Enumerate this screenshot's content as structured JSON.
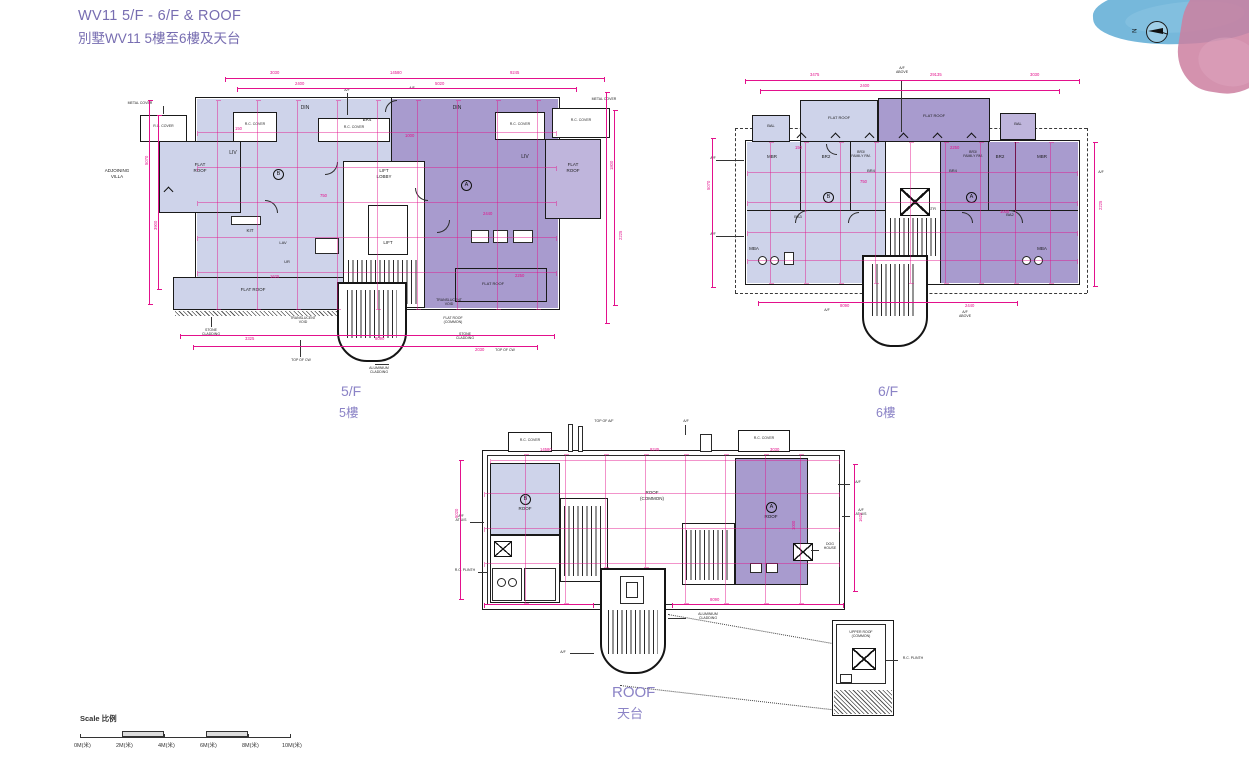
{
  "title": {
    "line1": "WV11  5/F - 6/F & ROOF",
    "line2": "別墅WV11  5樓至6樓及天台"
  },
  "compass": {
    "north": "N"
  },
  "captions": {
    "f5_en": "5/F",
    "f5_zh": "5樓",
    "f6_en": "6/F",
    "f6_zh": "6樓",
    "roof_en": "ROOF",
    "roof_zh": "天台"
  },
  "units": {
    "a": "A",
    "b": "B"
  },
  "rooms": {
    "flat_roof": "FLAT ROOF",
    "flat_1": "FLAT",
    "flat_2": "ROOF",
    "din": "DIN",
    "liv": "LIV",
    "kit": "KIT",
    "lav": "LAV",
    "ur": "UR",
    "lift": "LIFT",
    "lift_lobby_1": "LIFT",
    "lift_lobby_2": "LOBBY",
    "mbr": "MBR",
    "br2": "BR2",
    "br3": "BR3/",
    "family_rm": "FAMILY RM.",
    "br4": "BR4",
    "bal": "BAL",
    "mba": "MBA",
    "ba2": "BA2",
    "ba3": "BA3",
    "str": "STR",
    "roof": "ROOF",
    "roof_common_1": "ROOF",
    "roof_common_2": "(COMMON)",
    "upper_roof_1": "UPPER ROOF",
    "upper_roof_2": "(COMMON)",
    "flat_roof_common_1": "FLAT ROOF",
    "flat_roof_common_2": "(COMMON)"
  },
  "annos": {
    "adjoining_1": "ADJOINING",
    "adjoining_2": "VILLA",
    "metal_cover": "METAL COVER",
    "rc_cover": "R.C. COVER",
    "stone_1": "STONE",
    "stone_2": "CLADDING",
    "top_of_cw": "TOP OF CW",
    "translucent_1": "TRANSLUCENT",
    "translucent_2": "VOID",
    "af": "A/F",
    "af_above_1": "A/F",
    "af_above_2": "ABOVE",
    "top_of_af": "TOP OF A/F",
    "af_at_us_1": "A/F",
    "af_at_us_2": "AT U/S",
    "dog_1": "DOG",
    "dog_2": "HOUSE",
    "rc_plinth": "R.C. PLINTH",
    "alu_1": "ALUMINIUM",
    "alu_2": "CLADDING"
  },
  "scale": {
    "label": "Scale 比例",
    "ticks": [
      "0M(米)",
      "2M(米)",
      "4M(米)",
      "6M(米)",
      "8M(米)",
      "10M(米)"
    ]
  },
  "dims": [
    "3030",
    "14580",
    "9245",
    "2400",
    "150",
    "5070",
    "3900",
    "1800",
    "2225",
    "3325",
    "8090",
    "2030",
    "750",
    "1000",
    "2440",
    "3475",
    "5020",
    "1625",
    "29135",
    "2250"
  ]
}
